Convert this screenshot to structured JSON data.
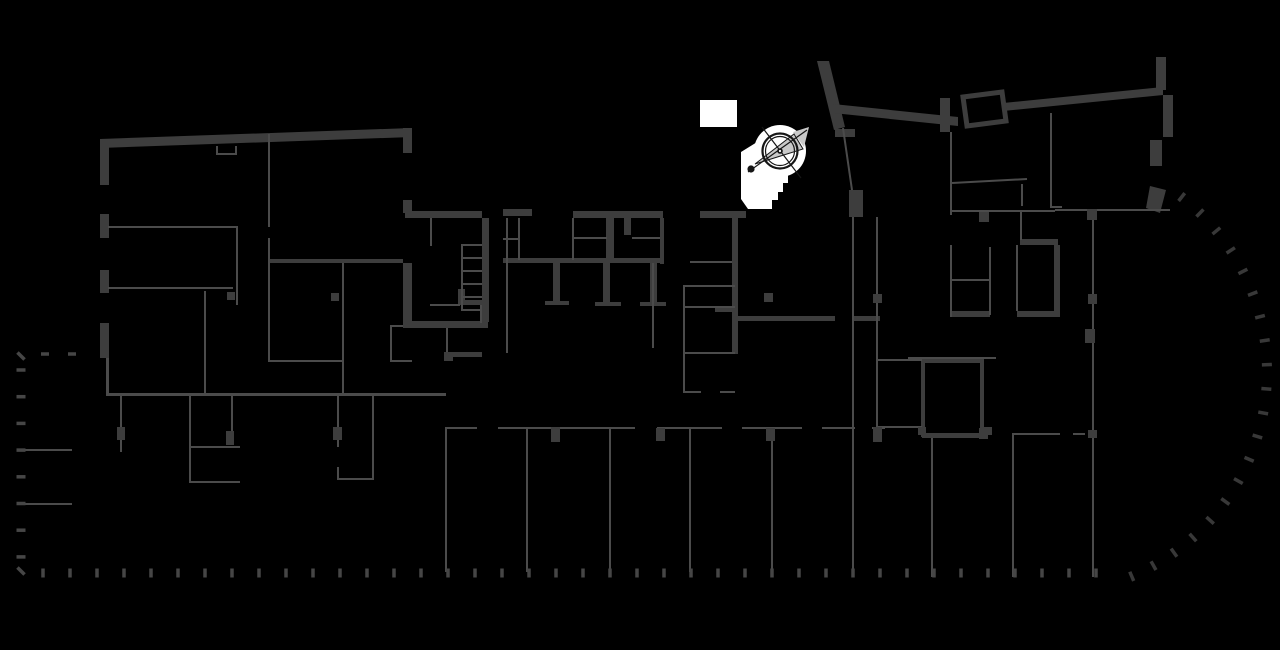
{
  "canvas": {
    "width": 1280,
    "height": 650,
    "background": "#000000"
  },
  "colors": {
    "bg": "#000000",
    "wall": "#3d3d3d",
    "thin": "#4b4b4b",
    "dash": "#464646",
    "arcdash": "#383838",
    "white": "#ffffff",
    "needle": "#c9c9c9",
    "ink": "#161616"
  },
  "icons": {
    "compass": "north-arrow-compass-icon"
  },
  "layers": [
    {
      "name": "white-patch",
      "type": "rects",
      "color": "white",
      "items": [
        [
          700,
          100,
          37,
          27
        ]
      ]
    },
    {
      "name": "stair-highlight",
      "type": "polys",
      "color": "white",
      "items": [
        "741,152 762,139 779,150 788,168 788,183 783,183 783,192 778,192 778,200 772,200 772,209 748,209 741,199"
      ]
    },
    {
      "name": "compass-badge",
      "type": "fcircles",
      "color": "white",
      "items": [
        [
          780,
          151,
          26
        ]
      ]
    },
    {
      "name": "outer-wall-polygons",
      "type": "polys",
      "color": "wall",
      "items": [
        "100,139 412,128 412,137 100,148",
        "817,61 829,61 845,127 834,130",
        "833,104 958,117 958,126 833,113",
        "1003,103 1163,87 1163,95 1003,111",
        "1150,186 1166,190 1160,213 1146,208"
      ]
    },
    {
      "name": "thick-walls",
      "type": "rects",
      "color": "wall",
      "items": [
        [
          100,
          139,
          9,
          46
        ],
        [
          100,
          214,
          9,
          24
        ],
        [
          100,
          270,
          9,
          23
        ],
        [
          100,
          323,
          9,
          35
        ],
        [
          403,
          128,
          9,
          25
        ],
        [
          403,
          200,
          9,
          13
        ],
        [
          403,
          263,
          9,
          58
        ],
        [
          268,
          259,
          135,
          4
        ],
        [
          405,
          211,
          77,
          7
        ],
        [
          503,
          209,
          29,
          7
        ],
        [
          573,
          211,
          90,
          7
        ],
        [
          700,
          211,
          46,
          7
        ],
        [
          482,
          218,
          7,
          104
        ],
        [
          403,
          321,
          85,
          7
        ],
        [
          458,
          289,
          7,
          13
        ],
        [
          458,
          300,
          26,
          5
        ],
        [
          503,
          258,
          160,
          5
        ],
        [
          606,
          218,
          8,
          42
        ],
        [
          624,
          218,
          7,
          17
        ],
        [
          660,
          218,
          4,
          46
        ],
        [
          553,
          263,
          7,
          39
        ],
        [
          545,
          301,
          24,
          4
        ],
        [
          603,
          263,
          7,
          39
        ],
        [
          595,
          302,
          26,
          4
        ],
        [
          650,
          263,
          7,
          39
        ],
        [
          640,
          302,
          26,
          4
        ],
        [
          732,
          218,
          6,
          136
        ],
        [
          715,
          307,
          23,
          5
        ],
        [
          738,
          316,
          97,
          5
        ],
        [
          853,
          316,
          27,
          5
        ],
        [
          849,
          190,
          14,
          27
        ],
        [
          835,
          129,
          20,
          8
        ],
        [
          446,
          352,
          36,
          5
        ],
        [
          940,
          98,
          10,
          34
        ],
        [
          1020,
          239,
          38,
          6
        ],
        [
          1054,
          245,
          6,
          72
        ],
        [
          952,
          311,
          38,
          6
        ],
        [
          1017,
          311,
          43,
          6
        ],
        [
          1156,
          57,
          10,
          33
        ],
        [
          1163,
          95,
          10,
          42
        ],
        [
          1150,
          140,
          12,
          26
        ],
        [
          922,
          433,
          60,
          5
        ]
      ]
    },
    {
      "name": "tilted-room-outline",
      "type": "outline_polys",
      "color": "wall",
      "sw": 5,
      "items": [
        "963,97 1002,92 1006,121 967,126"
      ]
    },
    {
      "name": "room-outlines-thick",
      "type": "outline_rects",
      "color": "wall",
      "sw": 4,
      "items": [
        [
          923,
          361,
          59,
          74
        ]
      ]
    },
    {
      "name": "thin-walls",
      "type": "rects",
      "color": "thin",
      "items": [
        [
          106,
          358,
          3,
          37
        ],
        [
          106,
          393,
          340,
          3
        ],
        [
          268,
          134,
          2,
          93
        ],
        [
          108,
          226,
          130,
          2
        ],
        [
          236,
          226,
          2,
          79
        ],
        [
          108,
          287,
          125,
          2
        ],
        [
          204,
          291,
          2,
          104
        ],
        [
          268,
          238,
          2,
          124
        ],
        [
          342,
          263,
          2,
          132
        ],
        [
          268,
          360,
          76,
          2
        ],
        [
          216,
          146,
          2,
          9
        ],
        [
          235,
          146,
          2,
          9
        ],
        [
          216,
          153,
          21,
          2
        ],
        [
          390,
          325,
          2,
          37
        ],
        [
          390,
          325,
          13,
          2
        ],
        [
          390,
          360,
          22,
          2
        ],
        [
          430,
          218,
          2,
          28
        ],
        [
          430,
          304,
          30,
          2
        ],
        [
          480,
          305,
          2,
          18
        ],
        [
          461,
          244,
          2,
          67
        ],
        [
          461,
          244,
          21,
          2
        ],
        [
          461,
          257,
          21,
          2
        ],
        [
          461,
          270,
          21,
          2
        ],
        [
          461,
          283,
          21,
          2
        ],
        [
          461,
          296,
          21,
          2
        ],
        [
          461,
          309,
          21,
          2
        ],
        [
          506,
          218,
          2,
          135
        ],
        [
          446,
          328,
          2,
          26
        ],
        [
          518,
          218,
          2,
          42
        ],
        [
          503,
          238,
          15,
          2
        ],
        [
          572,
          218,
          2,
          42
        ],
        [
          572,
          237,
          35,
          2
        ],
        [
          632,
          237,
          28,
          2
        ],
        [
          652,
          263,
          2,
          85
        ],
        [
          690,
          261,
          42,
          2
        ],
        [
          683,
          285,
          2,
          68
        ],
        [
          683,
          285,
          52,
          2
        ],
        [
          683,
          306,
          52,
          2
        ],
        [
          683,
          352,
          52,
          2
        ],
        [
          683,
          353,
          2,
          39
        ],
        [
          683,
          391,
          18,
          2
        ],
        [
          720,
          391,
          15,
          2
        ],
        [
          852,
          217,
          2,
          360
        ],
        [
          876,
          217,
          2,
          142
        ],
        [
          950,
          132,
          2,
          83
        ],
        [
          950,
          245,
          2,
          72
        ],
        [
          1021,
          184,
          2,
          22
        ],
        [
          1050,
          113,
          2,
          95
        ],
        [
          1050,
          206,
          12,
          2
        ],
        [
          952,
          210,
          103,
          2
        ],
        [
          1055,
          209,
          115,
          2
        ],
        [
          1020,
          212,
          2,
          28
        ],
        [
          989,
          247,
          2,
          68
        ],
        [
          1016,
          245,
          2,
          66
        ],
        [
          952,
          279,
          37,
          2
        ],
        [
          876,
          359,
          2,
          69
        ],
        [
          876,
          359,
          46,
          2
        ],
        [
          876,
          426,
          46,
          2
        ],
        [
          908,
          357,
          88,
          2
        ],
        [
          445,
          427,
          32,
          2
        ],
        [
          498,
          427,
          137,
          2
        ],
        [
          657,
          427,
          65,
          2
        ],
        [
          742,
          427,
          60,
          2
        ],
        [
          822,
          427,
          33,
          2
        ],
        [
          872,
          427,
          13,
          2
        ],
        [
          1013,
          433,
          47,
          2
        ],
        [
          1073,
          433,
          12,
          2
        ],
        [
          445,
          427,
          2,
          145
        ],
        [
          526,
          427,
          2,
          145
        ],
        [
          609,
          427,
          2,
          145
        ],
        [
          689,
          427,
          2,
          145
        ],
        [
          771,
          427,
          2,
          145
        ],
        [
          931,
          438,
          2,
          139
        ],
        [
          1012,
          433,
          2,
          144
        ],
        [
          1092,
          212,
          2,
          365
        ],
        [
          120,
          395,
          2,
          57
        ],
        [
          189,
          395,
          2,
          87
        ],
        [
          231,
          395,
          2,
          50
        ],
        [
          337,
          395,
          2,
          52
        ],
        [
          337,
          467,
          2,
          13
        ],
        [
          372,
          395,
          2,
          84
        ],
        [
          189,
          446,
          51,
          2
        ],
        [
          189,
          481,
          51,
          2
        ],
        [
          337,
          478,
          37,
          2
        ],
        [
          18,
          449,
          54,
          2
        ],
        [
          18,
          503,
          54,
          2
        ]
      ]
    },
    {
      "name": "thin-wall-lines",
      "type": "lines",
      "color": "thin",
      "sw": 2,
      "items": [
        [
          843,
          128,
          852,
          190
        ],
        [
          952,
          183,
          1027,
          179
        ]
      ]
    },
    {
      "name": "structural-columns",
      "type": "rects",
      "color": "wall",
      "items": [
        [
          117,
          427,
          8,
          13
        ],
        [
          226,
          431,
          8,
          14
        ],
        [
          333,
          427,
          9,
          13
        ],
        [
          551,
          427,
          9,
          15
        ],
        [
          656,
          428,
          9,
          13
        ],
        [
          766,
          428,
          9,
          13
        ],
        [
          873,
          427,
          9,
          15
        ],
        [
          979,
          428,
          9,
          11
        ],
        [
          918,
          427,
          8,
          8
        ],
        [
          984,
          427,
          8,
          8
        ],
        [
          1087,
          209,
          10,
          11
        ],
        [
          1088,
          294,
          9,
          10
        ],
        [
          1085,
          329,
          10,
          14
        ],
        [
          1088,
          430,
          9,
          8
        ],
        [
          979,
          212,
          10,
          10
        ],
        [
          764,
          293,
          9,
          9
        ],
        [
          873,
          294,
          9,
          9
        ],
        [
          444,
          352,
          9,
          9
        ],
        [
          227,
          292,
          8,
          8
        ],
        [
          331,
          293,
          8,
          8
        ]
      ]
    },
    {
      "name": "boundary-ticks-left",
      "type": "tickline",
      "color": "dash",
      "x0": 21,
      "y0": 370,
      "dx": 0,
      "dy": 26.7,
      "count": 8,
      "angle": 0,
      "len": 9,
      "th": 3.5
    },
    {
      "name": "boundary-ticks-top-stub",
      "type": "tickline",
      "color": "dash",
      "x0": 45,
      "y0": 354,
      "dx": 27,
      "dy": 0,
      "count": 2,
      "angle": 0,
      "len": 8,
      "th": 3.5
    },
    {
      "name": "boundary-corner-ticks",
      "type": "ticks",
      "color": "dash",
      "len": 10,
      "th": 3.5,
      "items": [
        [
          21,
          356,
          45
        ],
        [
          21,
          571,
          45
        ]
      ]
    },
    {
      "name": "boundary-ticks-bottom",
      "type": "tickline",
      "color": "dash",
      "x0": 43,
      "y0": 573,
      "dx": 27,
      "dy": 0,
      "count": 40,
      "angle": 90,
      "len": 9,
      "th": 3.5
    },
    {
      "name": "boundary-ticks-arc",
      "type": "tickarc",
      "color": "arcdash",
      "cx": 1045,
      "cy": 372,
      "r": 222,
      "a0": -52,
      "a1": 67,
      "count": 20,
      "len": 10,
      "th": 3.5
    },
    {
      "name": "compass-needle",
      "type": "polys",
      "color": "needle",
      "items": [
        "755,164 794,134 803,149",
        "793,132 809,127 804,147"
      ]
    },
    {
      "name": "compass-needle-outline",
      "type": "outline_polys",
      "color": "ink",
      "sw": 1,
      "items": [
        "755,164 794,134 803,149"
      ]
    },
    {
      "name": "compass-cross-lines",
      "type": "lines",
      "color": "ink",
      "sw": 1.2,
      "items": [
        [
          748,
          172,
          807,
          130
        ],
        [
          762,
          127,
          801,
          178
        ]
      ]
    },
    {
      "name": "compass-rings",
      "type": "scircles",
      "color": "ink",
      "items": [
        [
          780,
          151,
          17.5,
          2.2
        ],
        [
          780,
          151,
          14.5,
          1.2
        ]
      ]
    },
    {
      "name": "compass-dots",
      "type": "fcircles",
      "color": "ink",
      "items": [
        [
          751,
          169,
          3.6
        ],
        [
          780,
          151,
          2.8
        ]
      ]
    },
    {
      "name": "compass-center-pin",
      "type": "fcircles",
      "color": "white",
      "items": [
        [
          780,
          151,
          1.1
        ]
      ]
    }
  ]
}
